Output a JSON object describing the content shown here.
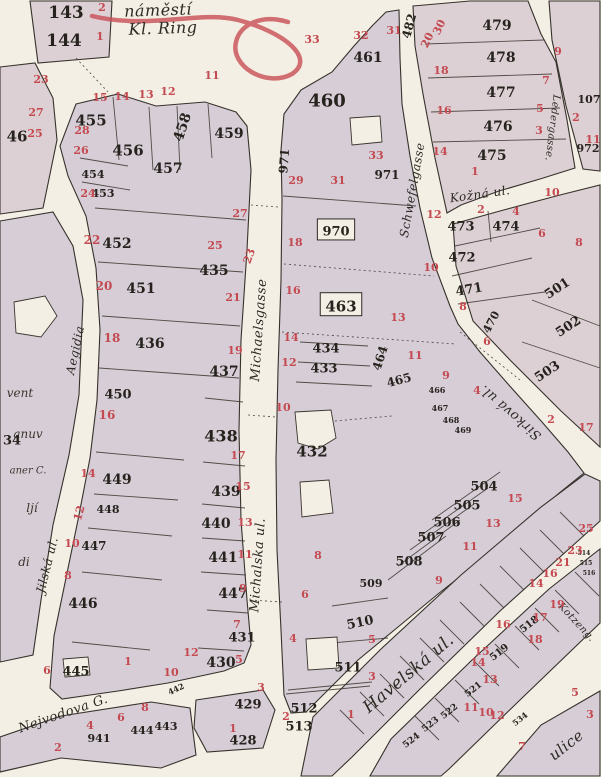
{
  "map": {
    "colors": {
      "ink": "#2c2a24",
      "red_number": "#c44950",
      "block_fill": "#d7cdd6",
      "street_fill": "#f4efe4",
      "pencil_mark": "#c84d55"
    },
    "street_labels": [
      {
        "t": "náměstí",
        "x": 158,
        "y": 10,
        "s": 16,
        "r": -2
      },
      {
        "t": "Kl. Ring",
        "x": 163,
        "y": 28,
        "s": 16,
        "r": -2
      },
      {
        "t": "Michaelsgasse",
        "x": 258,
        "y": 330,
        "s": 13,
        "r": -86
      },
      {
        "t": "Michalska ul.",
        "x": 257,
        "y": 565,
        "s": 13,
        "r": -86
      },
      {
        "t": "Schwefelgasse",
        "x": 412,
        "y": 190,
        "s": 12,
        "r": -80
      },
      {
        "t": "Ledergasse.",
        "x": 553,
        "y": 128,
        "s": 10,
        "r": 97
      },
      {
        "t": "Kožná ul.",
        "x": 480,
        "y": 194,
        "s": 12,
        "r": -8
      },
      {
        "t": "Sirková ul.",
        "x": 510,
        "y": 413,
        "s": 13,
        "r": -139
      },
      {
        "t": "Havelská ul.",
        "x": 408,
        "y": 673,
        "s": 17,
        "r": -40
      },
      {
        "t": "Nejvodova G.",
        "x": 63,
        "y": 713,
        "s": 13,
        "r": -19
      },
      {
        "t": "Jilská ul.",
        "x": 47,
        "y": 565,
        "s": 12,
        "r": -76
      },
      {
        "t": "Aegidia",
        "x": 75,
        "y": 350,
        "s": 12,
        "r": -78
      },
      {
        "t": "ulice",
        "x": 566,
        "y": 745,
        "s": 15,
        "r": -38
      },
      {
        "t": "Kotzeng.",
        "x": 577,
        "y": 622,
        "s": 10,
        "r": 47
      }
    ],
    "fragments": [
      {
        "t": "vent",
        "x": 20,
        "y": 393,
        "s": 12
      },
      {
        "t": "anuv",
        "x": 28,
        "y": 434,
        "s": 12
      },
      {
        "t": "aner C.",
        "x": 28,
        "y": 470,
        "s": 10
      },
      {
        "t": "ljí",
        "x": 32,
        "y": 508,
        "s": 12
      },
      {
        "t": "di",
        "x": 24,
        "y": 562,
        "s": 12
      }
    ],
    "parcel_numbers": [
      {
        "t": "143",
        "x": 66,
        "y": 12,
        "s": 17
      },
      {
        "t": "144",
        "x": 64,
        "y": 40,
        "s": 17
      },
      {
        "t": "46",
        "x": 17,
        "y": 136,
        "s": 15
      },
      {
        "t": "455",
        "x": 91,
        "y": 120,
        "s": 15
      },
      {
        "t": "456",
        "x": 128,
        "y": 150,
        "s": 15
      },
      {
        "t": "458",
        "x": 182,
        "y": 127,
        "s": 14,
        "r": -72
      },
      {
        "t": "457",
        "x": 168,
        "y": 168,
        "s": 14
      },
      {
        "t": "459",
        "x": 229,
        "y": 133,
        "s": 14
      },
      {
        "t": "454",
        "x": 93,
        "y": 174,
        "s": 11
      },
      {
        "t": "453",
        "x": 103,
        "y": 193,
        "s": 11
      },
      {
        "t": "452",
        "x": 117,
        "y": 243,
        "s": 14
      },
      {
        "t": "451",
        "x": 141,
        "y": 288,
        "s": 14
      },
      {
        "t": "436",
        "x": 150,
        "y": 343,
        "s": 14
      },
      {
        "t": "435",
        "x": 214,
        "y": 270,
        "s": 14
      },
      {
        "t": "450",
        "x": 118,
        "y": 394,
        "s": 13
      },
      {
        "t": "437",
        "x": 224,
        "y": 371,
        "s": 14
      },
      {
        "t": "438",
        "x": 221,
        "y": 436,
        "s": 16
      },
      {
        "t": "449",
        "x": 117,
        "y": 479,
        "s": 14
      },
      {
        "t": "448",
        "x": 108,
        "y": 509,
        "s": 11
      },
      {
        "t": "439",
        "x": 226,
        "y": 491,
        "s": 14
      },
      {
        "t": "440",
        "x": 216,
        "y": 523,
        "s": 14
      },
      {
        "t": "447",
        "x": 94,
        "y": 546,
        "s": 12
      },
      {
        "t": "441",
        "x": 223,
        "y": 557,
        "s": 14
      },
      {
        "t": "447",
        "x": 233,
        "y": 593,
        "s": 14
      },
      {
        "t": "446",
        "x": 83,
        "y": 603,
        "s": 14
      },
      {
        "t": "445",
        "x": 76,
        "y": 671,
        "s": 13
      },
      {
        "t": "431",
        "x": 242,
        "y": 637,
        "s": 13
      },
      {
        "t": "430",
        "x": 221,
        "y": 662,
        "s": 14
      },
      {
        "t": "429",
        "x": 248,
        "y": 704,
        "s": 13
      },
      {
        "t": "428",
        "x": 243,
        "y": 740,
        "s": 13
      },
      {
        "t": "941",
        "x": 99,
        "y": 738,
        "s": 11
      },
      {
        "t": "444",
        "x": 142,
        "y": 730,
        "s": 11
      },
      {
        "t": "443",
        "x": 166,
        "y": 726,
        "s": 11
      },
      {
        "t": "442",
        "x": 176,
        "y": 689,
        "s": 8,
        "r": -25
      },
      {
        "t": "34",
        "x": 12,
        "y": 440,
        "s": 13
      },
      {
        "t": "460",
        "x": 327,
        "y": 100,
        "s": 18
      },
      {
        "t": "461",
        "x": 368,
        "y": 57,
        "s": 14
      },
      {
        "t": "971",
        "x": 284,
        "y": 161,
        "s": 12,
        "r": -85
      },
      {
        "t": "971",
        "x": 387,
        "y": 175,
        "s": 12
      },
      {
        "t": "970",
        "x": 336,
        "y": 231,
        "s": 13,
        "box": true
      },
      {
        "t": "463",
        "x": 341,
        "y": 306,
        "s": 15,
        "box": true
      },
      {
        "t": "434",
        "x": 326,
        "y": 348,
        "s": 13
      },
      {
        "t": "433",
        "x": 324,
        "y": 368,
        "s": 13
      },
      {
        "t": "464",
        "x": 380,
        "y": 358,
        "s": 12,
        "r": -72
      },
      {
        "t": "465",
        "x": 399,
        "y": 380,
        "s": 12,
        "r": -15
      },
      {
        "t": "432",
        "x": 312,
        "y": 451,
        "s": 15
      },
      {
        "t": "466",
        "x": 437,
        "y": 390,
        "s": 8
      },
      {
        "t": "467",
        "x": 440,
        "y": 408,
        "s": 8
      },
      {
        "t": "468",
        "x": 451,
        "y": 420,
        "s": 8
      },
      {
        "t": "469",
        "x": 463,
        "y": 430,
        "s": 8
      },
      {
        "t": "504",
        "x": 484,
        "y": 486,
        "s": 13
      },
      {
        "t": "505",
        "x": 467,
        "y": 505,
        "s": 13
      },
      {
        "t": "506",
        "x": 447,
        "y": 522,
        "s": 13
      },
      {
        "t": "507",
        "x": 431,
        "y": 537,
        "s": 13
      },
      {
        "t": "508",
        "x": 409,
        "y": 561,
        "s": 13
      },
      {
        "t": "509",
        "x": 371,
        "y": 583,
        "s": 11
      },
      {
        "t": "510",
        "x": 360,
        "y": 622,
        "s": 13,
        "r": -12
      },
      {
        "t": "511",
        "x": 348,
        "y": 667,
        "s": 13
      },
      {
        "t": "512",
        "x": 304,
        "y": 708,
        "s": 13
      },
      {
        "t": "513",
        "x": 299,
        "y": 726,
        "s": 13
      },
      {
        "t": "479",
        "x": 497,
        "y": 25,
        "s": 14
      },
      {
        "t": "478",
        "x": 501,
        "y": 57,
        "s": 14
      },
      {
        "t": "477",
        "x": 501,
        "y": 92,
        "s": 14
      },
      {
        "t": "476",
        "x": 498,
        "y": 126,
        "s": 14
      },
      {
        "t": "475",
        "x": 492,
        "y": 155,
        "s": 14
      },
      {
        "t": "482",
        "x": 409,
        "y": 26,
        "s": 12,
        "r": -75
      },
      {
        "t": "473",
        "x": 461,
        "y": 226,
        "s": 13
      },
      {
        "t": "474",
        "x": 506,
        "y": 226,
        "s": 13
      },
      {
        "t": "472",
        "x": 462,
        "y": 257,
        "s": 13
      },
      {
        "t": "471",
        "x": 469,
        "y": 289,
        "s": 13,
        "r": -10
      },
      {
        "t": "470",
        "x": 491,
        "y": 322,
        "s": 11,
        "r": -62
      },
      {
        "t": "501",
        "x": 557,
        "y": 288,
        "s": 13,
        "r": -33
      },
      {
        "t": "502",
        "x": 568,
        "y": 326,
        "s": 13,
        "r": -33
      },
      {
        "t": "503",
        "x": 547,
        "y": 371,
        "s": 13,
        "r": -33
      },
      {
        "t": "107",
        "x": 589,
        "y": 99,
        "s": 11
      },
      {
        "t": "972",
        "x": 588,
        "y": 148,
        "s": 11
      },
      {
        "t": "518",
        "x": 529,
        "y": 624,
        "s": 10,
        "r": -38
      },
      {
        "t": "519",
        "x": 499,
        "y": 652,
        "s": 10,
        "r": -38
      },
      {
        "t": "521",
        "x": 473,
        "y": 689,
        "s": 9,
        "r": -38
      },
      {
        "t": "522",
        "x": 449,
        "y": 711,
        "s": 9,
        "r": -38
      },
      {
        "t": "523",
        "x": 430,
        "y": 724,
        "s": 9,
        "r": -38
      },
      {
        "t": "524",
        "x": 411,
        "y": 740,
        "s": 9,
        "r": -38
      },
      {
        "t": "534",
        "x": 520,
        "y": 719,
        "s": 8,
        "r": -38
      },
      {
        "t": "514",
        "x": 584,
        "y": 553,
        "s": 6
      },
      {
        "t": "515",
        "x": 586,
        "y": 563,
        "s": 6
      },
      {
        "t": "516",
        "x": 589,
        "y": 573,
        "s": 6
      }
    ],
    "house_numbers": [
      {
        "t": "2",
        "x": 102,
        "y": 7
      },
      {
        "t": "1",
        "x": 100,
        "y": 36
      },
      {
        "t": "23",
        "x": 41,
        "y": 79
      },
      {
        "t": "27",
        "x": 36,
        "y": 112
      },
      {
        "t": "25",
        "x": 35,
        "y": 133
      },
      {
        "t": "15",
        "x": 100,
        "y": 97
      },
      {
        "t": "14",
        "x": 122,
        "y": 96
      },
      {
        "t": "13",
        "x": 146,
        "y": 94
      },
      {
        "t": "12",
        "x": 168,
        "y": 91
      },
      {
        "t": "11",
        "x": 212,
        "y": 75
      },
      {
        "t": "28",
        "x": 82,
        "y": 130
      },
      {
        "t": "26",
        "x": 81,
        "y": 150
      },
      {
        "t": "24",
        "x": 88,
        "y": 193
      },
      {
        "t": "22",
        "x": 92,
        "y": 240,
        "s": 12
      },
      {
        "t": "20",
        "x": 104,
        "y": 286,
        "s": 12
      },
      {
        "t": "18",
        "x": 112,
        "y": 338,
        "s": 12
      },
      {
        "t": "16",
        "x": 107,
        "y": 415,
        "s": 12
      },
      {
        "t": "14",
        "x": 88,
        "y": 473
      },
      {
        "t": "12",
        "x": 79,
        "y": 513,
        "r": -75
      },
      {
        "t": "10",
        "x": 72,
        "y": 543
      },
      {
        "t": "8",
        "x": 68,
        "y": 575
      },
      {
        "t": "6",
        "x": 47,
        "y": 670
      },
      {
        "t": "1",
        "x": 128,
        "y": 661
      },
      {
        "t": "2",
        "x": 58,
        "y": 747
      },
      {
        "t": "4",
        "x": 90,
        "y": 725
      },
      {
        "t": "6",
        "x": 121,
        "y": 717
      },
      {
        "t": "8",
        "x": 145,
        "y": 707
      },
      {
        "t": "10",
        "x": 171,
        "y": 672
      },
      {
        "t": "12",
        "x": 191,
        "y": 652
      },
      {
        "t": "27",
        "x": 240,
        "y": 213
      },
      {
        "t": "25",
        "x": 215,
        "y": 245
      },
      {
        "t": "23",
        "x": 249,
        "y": 256,
        "r": -70
      },
      {
        "t": "21",
        "x": 233,
        "y": 297
      },
      {
        "t": "19",
        "x": 235,
        "y": 350
      },
      {
        "t": "17",
        "x": 238,
        "y": 455
      },
      {
        "t": "15",
        "x": 243,
        "y": 486
      },
      {
        "t": "13",
        "x": 245,
        "y": 522
      },
      {
        "t": "11",
        "x": 245,
        "y": 554
      },
      {
        "t": "9",
        "x": 243,
        "y": 588
      },
      {
        "t": "7",
        "x": 237,
        "y": 624
      },
      {
        "t": "5",
        "x": 239,
        "y": 659
      },
      {
        "t": "3",
        "x": 261,
        "y": 687
      },
      {
        "t": "1",
        "x": 233,
        "y": 728
      },
      {
        "t": "33",
        "x": 312,
        "y": 39
      },
      {
        "t": "32",
        "x": 361,
        "y": 35
      },
      {
        "t": "31",
        "x": 394,
        "y": 30
      },
      {
        "t": "33",
        "x": 376,
        "y": 155
      },
      {
        "t": "31",
        "x": 338,
        "y": 180
      },
      {
        "t": "29",
        "x": 296,
        "y": 180
      },
      {
        "t": "18",
        "x": 295,
        "y": 242
      },
      {
        "t": "16",
        "x": 293,
        "y": 290
      },
      {
        "t": "14",
        "x": 291,
        "y": 337
      },
      {
        "t": "12",
        "x": 289,
        "y": 362
      },
      {
        "t": "10",
        "x": 283,
        "y": 407
      },
      {
        "t": "8",
        "x": 318,
        "y": 555
      },
      {
        "t": "6",
        "x": 305,
        "y": 594
      },
      {
        "t": "4",
        "x": 293,
        "y": 638
      },
      {
        "t": "2",
        "x": 286,
        "y": 716
      },
      {
        "t": "13",
        "x": 398,
        "y": 317
      },
      {
        "t": "11",
        "x": 415,
        "y": 355
      },
      {
        "t": "9",
        "x": 446,
        "y": 375
      },
      {
        "t": "15",
        "x": 515,
        "y": 498
      },
      {
        "t": "13",
        "x": 493,
        "y": 523
      },
      {
        "t": "11",
        "x": 470,
        "y": 546
      },
      {
        "t": "9",
        "x": 439,
        "y": 580
      },
      {
        "t": "5",
        "x": 372,
        "y": 639
      },
      {
        "t": "3",
        "x": 372,
        "y": 676
      },
      {
        "t": "1",
        "x": 351,
        "y": 714
      },
      {
        "t": "30",
        "x": 439,
        "y": 27,
        "r": -65
      },
      {
        "t": "20",
        "x": 427,
        "y": 40,
        "r": -65
      },
      {
        "t": "18",
        "x": 441,
        "y": 70
      },
      {
        "t": "16",
        "x": 444,
        "y": 110
      },
      {
        "t": "14",
        "x": 440,
        "y": 151
      },
      {
        "t": "12",
        "x": 434,
        "y": 214
      },
      {
        "t": "10",
        "x": 431,
        "y": 267
      },
      {
        "t": "9",
        "x": 558,
        "y": 51
      },
      {
        "t": "7",
        "x": 546,
        "y": 80
      },
      {
        "t": "5",
        "x": 540,
        "y": 108
      },
      {
        "t": "3",
        "x": 539,
        "y": 130
      },
      {
        "t": "1",
        "x": 475,
        "y": 171
      },
      {
        "t": "2",
        "x": 481,
        "y": 209
      },
      {
        "t": "4",
        "x": 516,
        "y": 211
      },
      {
        "t": "10",
        "x": 552,
        "y": 192
      },
      {
        "t": "8",
        "x": 463,
        "y": 306
      },
      {
        "t": "6",
        "x": 487,
        "y": 341
      },
      {
        "t": "6",
        "x": 542,
        "y": 233
      },
      {
        "t": "8",
        "x": 579,
        "y": 242
      },
      {
        "t": "4",
        "x": 477,
        "y": 390
      },
      {
        "t": "2",
        "x": 551,
        "y": 419
      },
      {
        "t": "17",
        "x": 586,
        "y": 427
      },
      {
        "t": "2",
        "x": 576,
        "y": 117
      },
      {
        "t": "11",
        "x": 593,
        "y": 139
      },
      {
        "t": "19",
        "x": 557,
        "y": 604
      },
      {
        "t": "17",
        "x": 540,
        "y": 617
      },
      {
        "t": "16",
        "x": 503,
        "y": 624
      },
      {
        "t": "15",
        "x": 482,
        "y": 651
      },
      {
        "t": "14",
        "x": 478,
        "y": 662
      },
      {
        "t": "13",
        "x": 490,
        "y": 679
      },
      {
        "t": "12",
        "x": 497,
        "y": 715
      },
      {
        "t": "11",
        "x": 471,
        "y": 707
      },
      {
        "t": "10",
        "x": 486,
        "y": 712
      },
      {
        "t": "18",
        "x": 535,
        "y": 639
      },
      {
        "t": "25",
        "x": 586,
        "y": 528
      },
      {
        "t": "23",
        "x": 575,
        "y": 550
      },
      {
        "t": "21",
        "x": 563,
        "y": 562
      },
      {
        "t": "16",
        "x": 550,
        "y": 573
      },
      {
        "t": "14",
        "x": 536,
        "y": 583
      },
      {
        "t": "7",
        "x": 522,
        "y": 746
      },
      {
        "t": "5",
        "x": 575,
        "y": 692
      },
      {
        "t": "3",
        "x": 590,
        "y": 714
      }
    ]
  }
}
